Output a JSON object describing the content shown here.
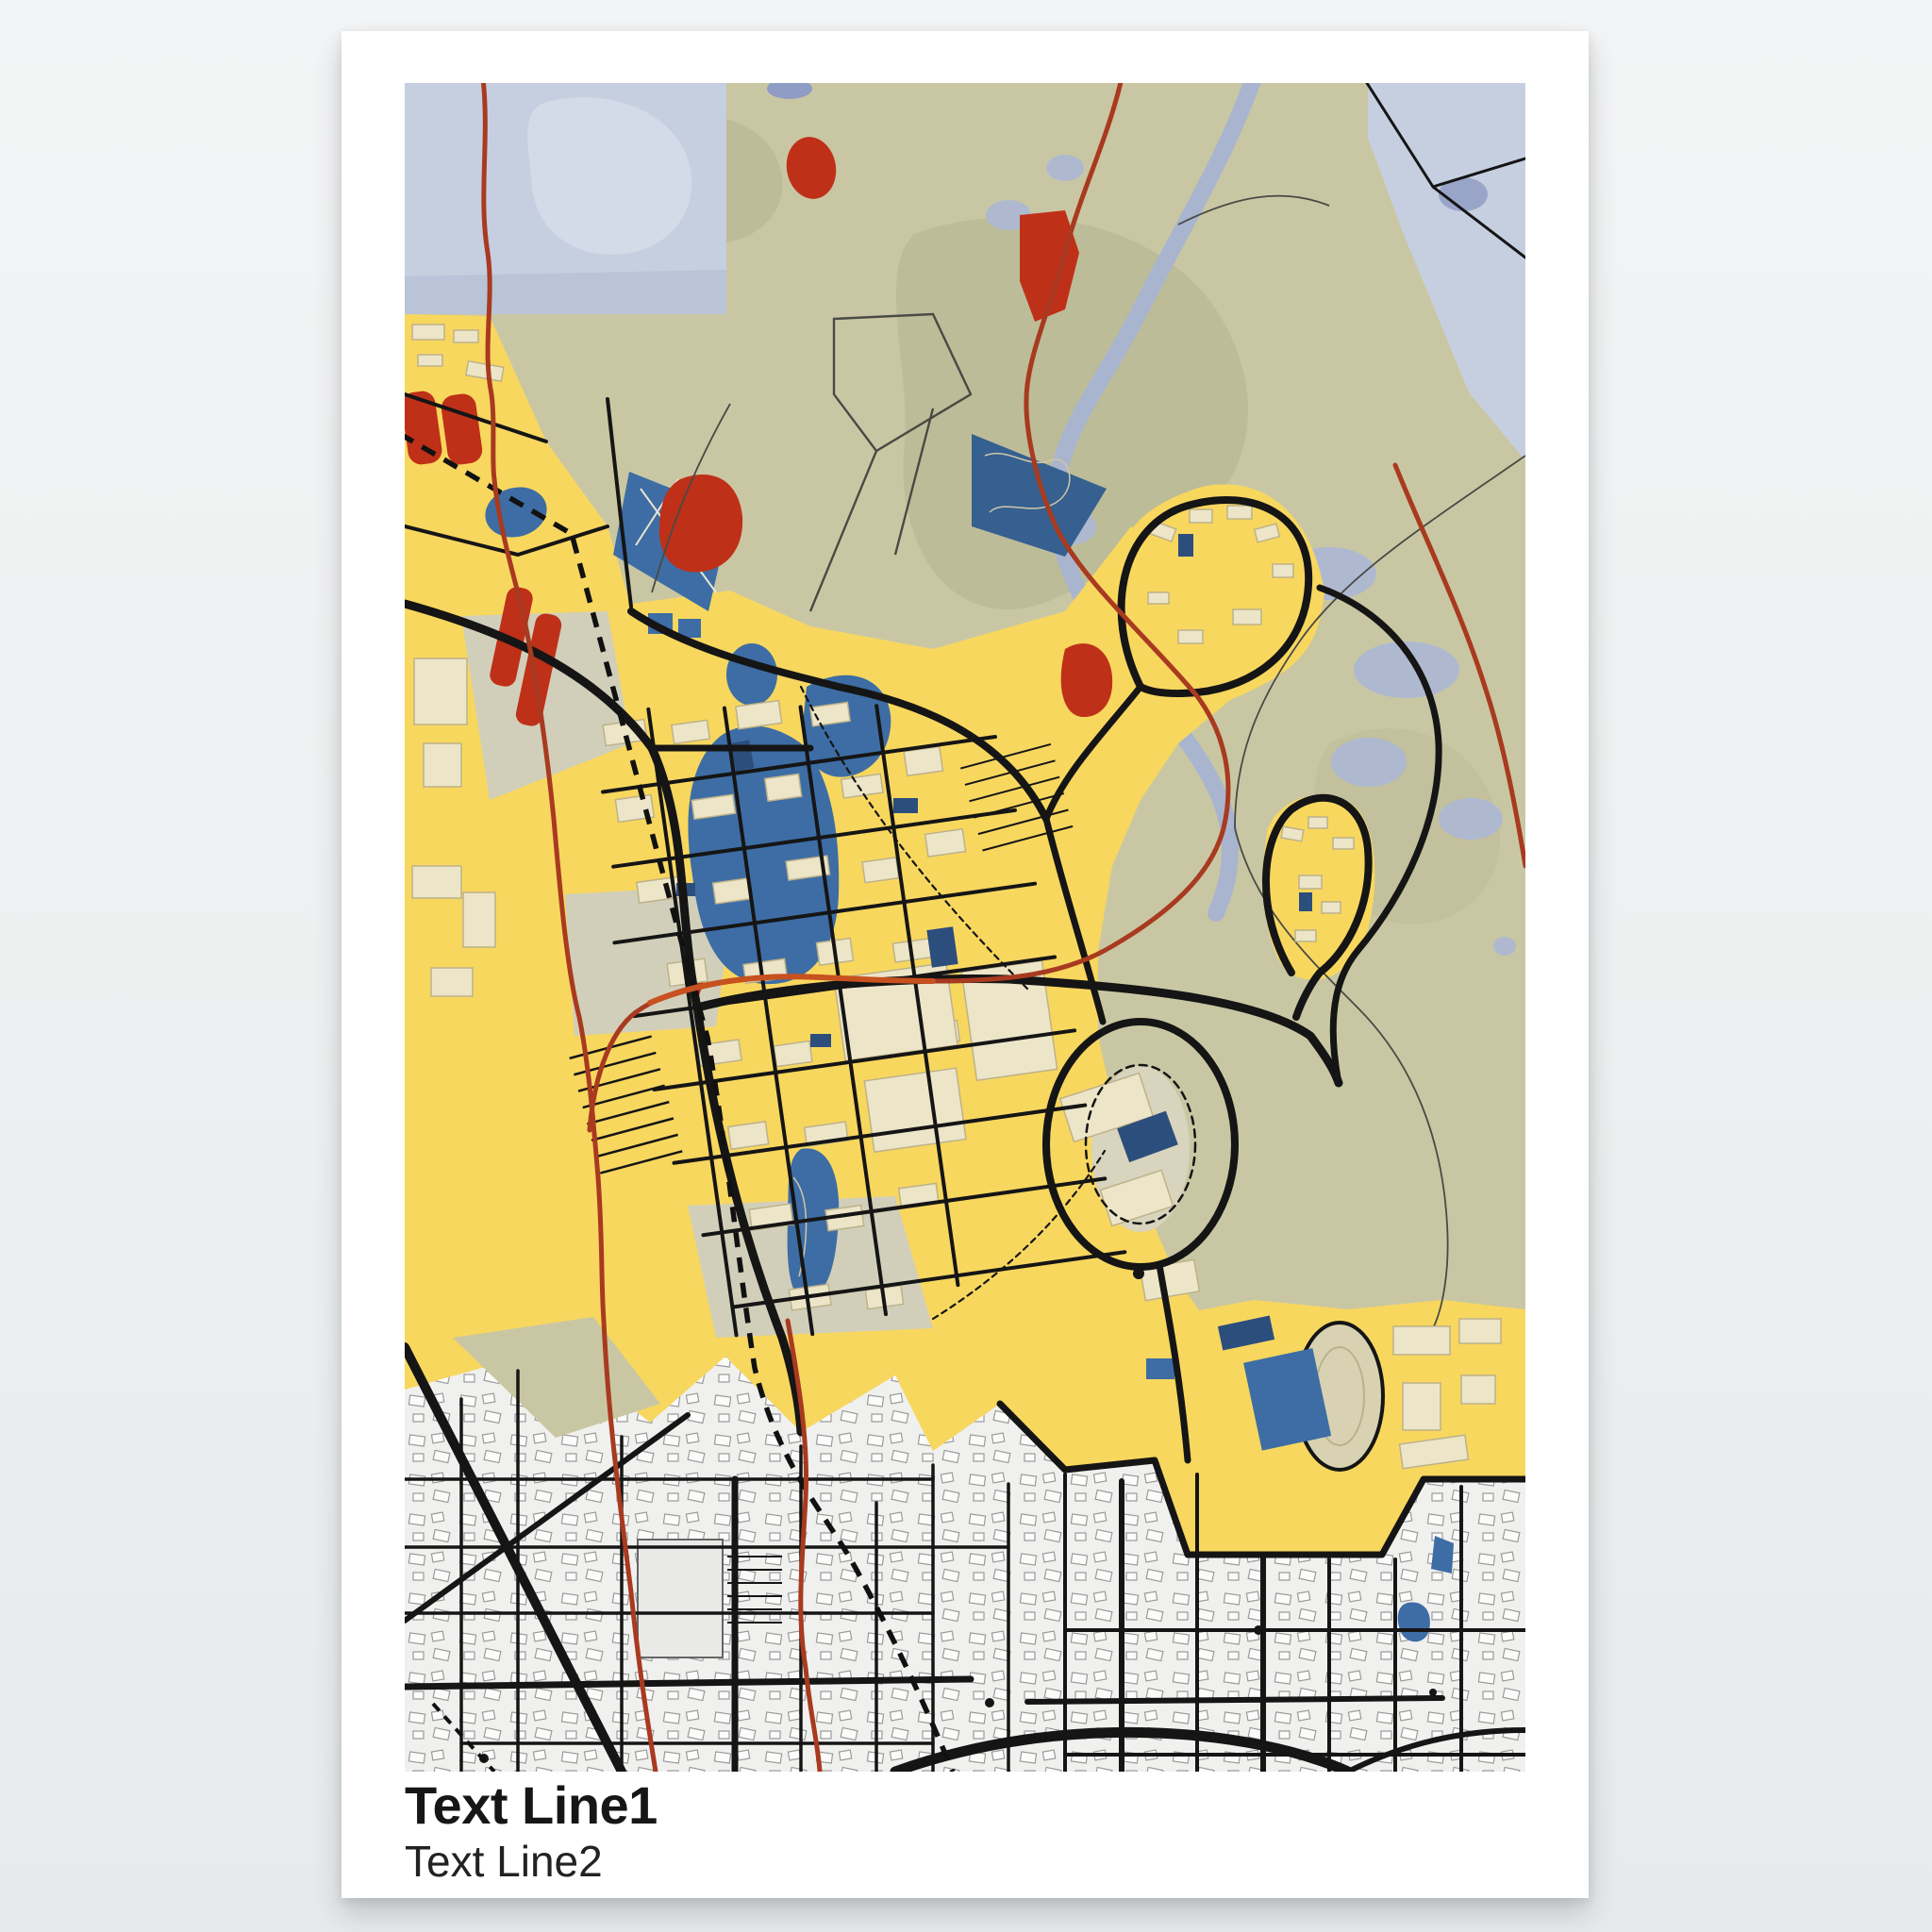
{
  "poster": {
    "text_line1": "Text Line1",
    "text_line2": "Text Line2"
  },
  "map": {
    "type": "stylized-city-map-poster",
    "text_labels_on_map": [],
    "layers": [
      "parkland",
      "water-area",
      "river",
      "wetland",
      "urban-area",
      "residential-area",
      "lakes",
      "sports-fields",
      "stadium",
      "buildings",
      "roads",
      "railway",
      "trails",
      "pools"
    ]
  },
  "palette": {
    "page_background": "#edeff0",
    "poster_background": "#ffffff",
    "parkland": "#c9c7a3",
    "parkland_dark": "#bdbc98",
    "water_light": "#c6cfe0",
    "water_inner": "#d3dae8",
    "river": "#a9b5ce",
    "urban_yellow": "#f8d75f",
    "residential_gray": "#f0f0ee",
    "building_cream": "#ece5c8",
    "lake_blue": "#3d6da4",
    "building_navy": "#2c4e7d",
    "accent_red": "#bf3018",
    "trail_red": "#a83a20",
    "trail_orange": "#c7511f",
    "road_black": "#151515",
    "caption_text": "#161616"
  }
}
